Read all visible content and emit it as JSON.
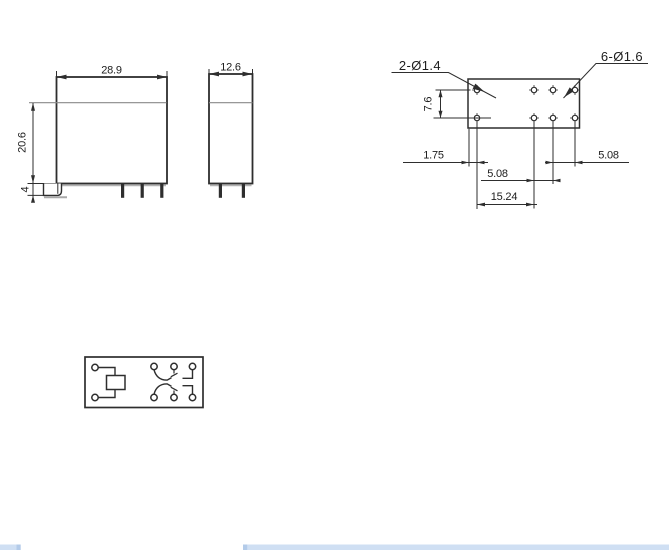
{
  "colors": {
    "ink": "#2e2e2e",
    "seam_gray": "#8a8a8a",
    "shadow_gray": "#a8a8a8",
    "bar_fill": "#cfdff3",
    "bar_edge": "#b3cbe9",
    "background": "#ffffff"
  },
  "side_view": {
    "width_dim": "28.9",
    "height_dim": "20.6",
    "standoff_dim": "4"
  },
  "end_view": {
    "width_dim": "12.6"
  },
  "pcb_layout": {
    "coil_holes_callout": "2-Ø1.4",
    "contact_holes_callout": "6-Ø1.6",
    "row_pitch_dim": "7.6",
    "edge_offset_dim": "1.75",
    "pitch_dim_mid": "5.08",
    "pitch_dim_right": "5.08",
    "span_dim": "15.24"
  }
}
